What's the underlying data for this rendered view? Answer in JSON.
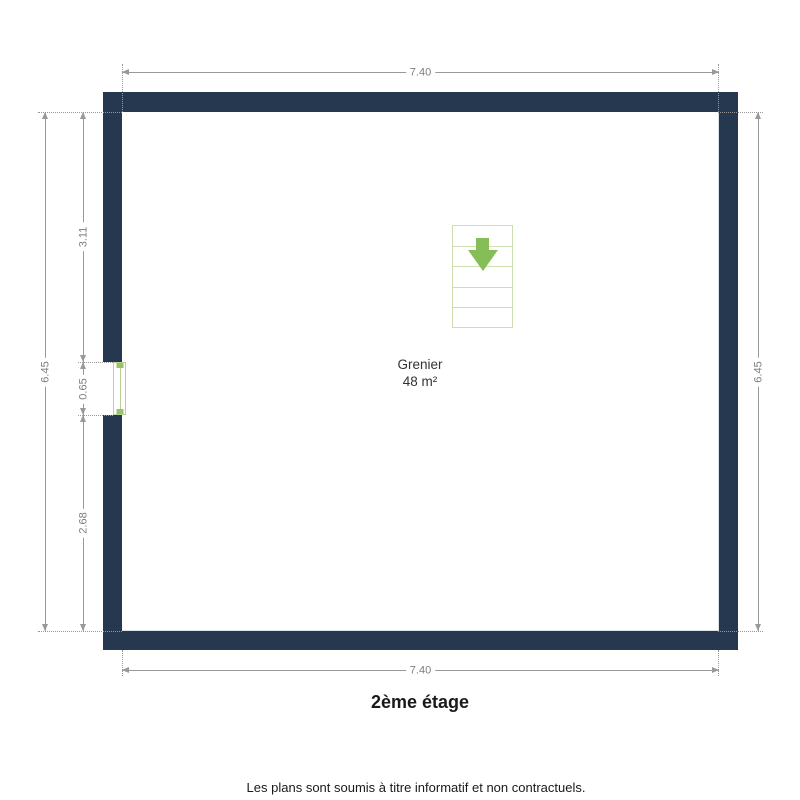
{
  "floor_plan": {
    "title": "2ème étage",
    "footer": "Les plans sont soumis à titre informatif et non contractuels.",
    "room": {
      "name": "Grenier",
      "area": "48 m²"
    },
    "dimensions": {
      "width_top": "7.40",
      "width_bottom": "7.40",
      "height_left": "6.45",
      "height_right": "6.45",
      "left_upper": "3.11",
      "left_window": "0.65",
      "left_lower": "2.68"
    },
    "icons": {
      "stairs_direction": "down-arrow"
    },
    "colors": {
      "wall": "#263750",
      "wall_inner_edge": "#d9e2e9",
      "dimension_line": "#999999",
      "dimension_text": "#7d7d7d",
      "stairs_border": "#cddfae",
      "stairs_arrow": "#85bd57",
      "window_frame": "#b8d295",
      "window_tick": "#9cc06c",
      "text_primary": "#1a1a1a"
    }
  }
}
